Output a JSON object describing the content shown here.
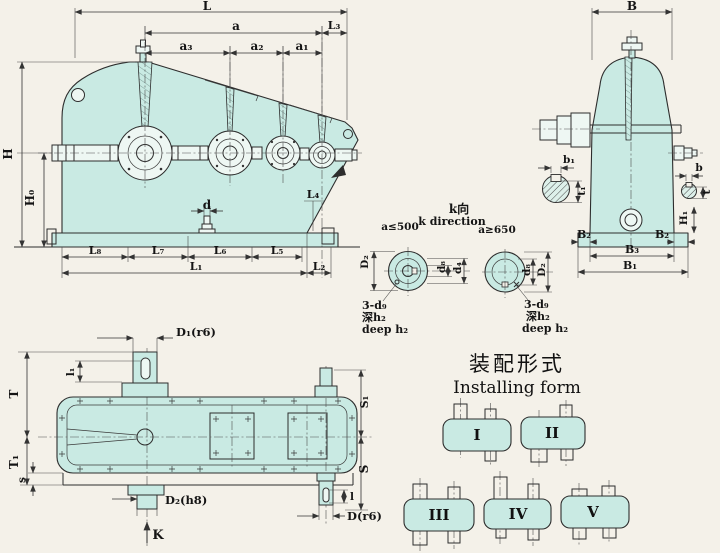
{
  "colors": {
    "paper": "#f4f1e9",
    "housing_fill": "#c9eae3",
    "line": "#2d2d2d",
    "text": "#141414"
  },
  "side_view": {
    "L": "L",
    "a": "a",
    "L3": "L₃",
    "a3": "a₃",
    "a2": "a₂",
    "a1": "a₁",
    "H": "H",
    "H0": "H₀",
    "d": "d",
    "L4": "L₄",
    "L8": "L₈",
    "L7": "L₇",
    "L6": "L₆",
    "L5": "L₅",
    "L1": "L₁",
    "L2": "L₂"
  },
  "end_view": {
    "B": "B",
    "b1": "b₁",
    "t1": "t₁",
    "b": "b",
    "t": "t",
    "H1": "H₁",
    "B2_left": "B₂",
    "B2_right": "B₂",
    "B3": "B₃",
    "B1": "B₁"
  },
  "k_view": {
    "title_cn": "k向",
    "title_en": "k direction",
    "left": {
      "cond": "a≤500",
      "D2": "D₂",
      "d8": "d₈",
      "d4": "d₄",
      "holes": "3-d₉",
      "depth_cn": "深h₂",
      "depth_en": "deep h₂"
    },
    "right": {
      "cond": "a≥650",
      "d8": "d₈",
      "D2": "D₂",
      "holes": "3-d₉",
      "depth_cn": "深h₂",
      "depth_en": "deep h₂"
    }
  },
  "top_view": {
    "D1": "D₁(r6)",
    "l1": "l₁",
    "T": "T",
    "T1": "T₁",
    "s": "s",
    "S1": "S₁",
    "S": "S",
    "D2": "D₂(h8)",
    "D": "D(r6)",
    "l": "l",
    "K": "K"
  },
  "installing_form": {
    "title_cn": "装配形式",
    "title_en": "Installing form",
    "forms": [
      {
        "numeral": "I"
      },
      {
        "numeral": "II"
      },
      {
        "numeral": "III"
      },
      {
        "numeral": "IV"
      },
      {
        "numeral": "V"
      }
    ]
  }
}
